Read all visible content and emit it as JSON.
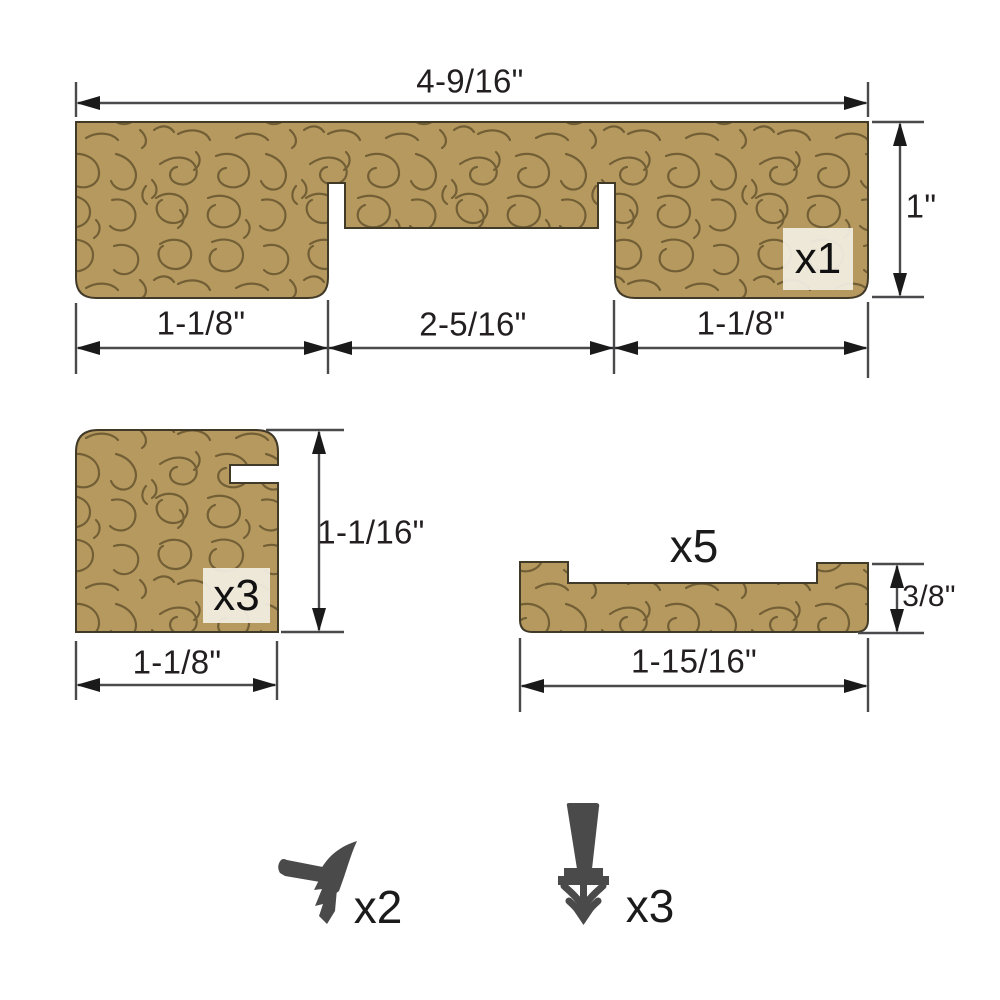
{
  "diagram": {
    "title_hint": "door jamb kit profile drawing",
    "top_piece": {
      "count_label": "x1",
      "width_label": "4-9/16\"",
      "height_label": "1\"",
      "bottom_left_label": "1-1/8\"",
      "bottom_middle_label": "2-5/16\"",
      "bottom_right_label": "1-1/8\""
    },
    "corner_piece": {
      "count_label": "x3",
      "height_label": "1-1/16\"",
      "width_label": "1-1/8\""
    },
    "stop_piece": {
      "count_label": "x5",
      "height_label": "3/8\"",
      "width_label": "1-15/16\""
    },
    "corner_seal": {
      "count_label": "x2"
    },
    "barb_seal": {
      "count_label": "x3"
    }
  },
  "colors": {
    "background": "#ffffff",
    "wood_fill": "#b6995e",
    "wood_grain": "#6f5b33",
    "wood_outline": "#423a28",
    "dimension_line": "#4a4a4c",
    "arrow": "#1a1a1a",
    "text": "#231f20",
    "badge_bg": "#f2eee3",
    "seal": "#4a4a4a"
  }
}
